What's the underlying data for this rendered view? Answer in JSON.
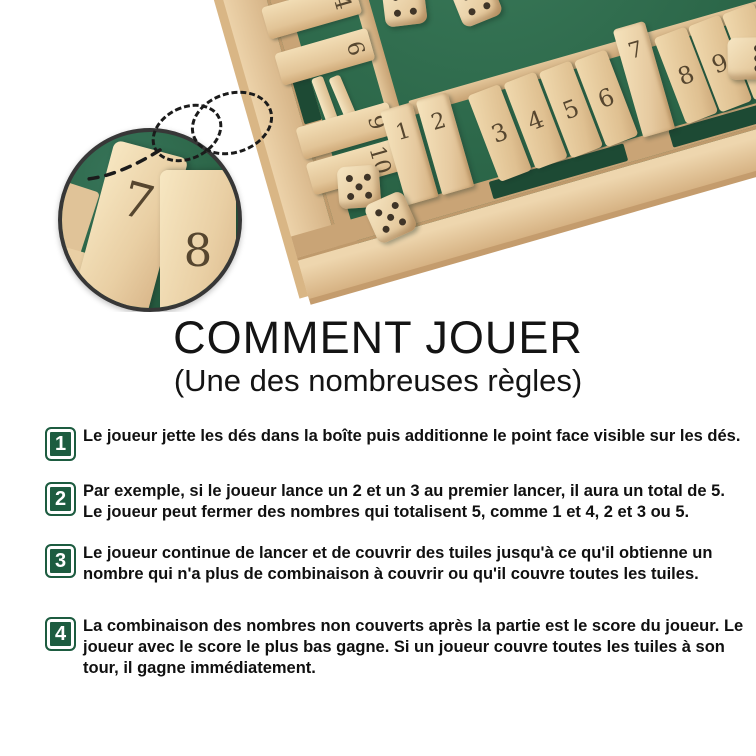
{
  "heading": {
    "title": "COMMENT JOUER",
    "subtitle": "(Une des nombreuses règles)"
  },
  "steps": [
    {
      "number": "1",
      "text": "Le joueur jette les dés dans la boîte puis additionne le point face visible sur les dés."
    },
    {
      "number": "2",
      "text": "Par exemple, si le joueur lance un 2 et un 3 au premier lancer, il aura un total de 5. Le joueur peut fermer des nombres qui totalisent 5, comme 1 et 4, 2 et 3 ou 5."
    },
    {
      "number": "3",
      "text": "Le joueur continue de lancer et de couvrir des tuiles jusqu'à ce qu'il obtienne un nombre qui n'a plus de combinaison à couvrir ou qu'il couvre toutes les tuiles."
    },
    {
      "number": "4",
      "text": "La combinaison des nombres non couverts après la partie est le score du joueur. Le joueur avec le score le plus bas gagne. Si un joueur couvre toutes les tuiles à son tour, il gagne immédiatement."
    }
  ],
  "photo": {
    "board": {
      "felt_color": "#2c6749",
      "wood_color": "#e8cfa6",
      "number_color": "#56462f",
      "left_tiles": [
        "4",
        "6",
        "9",
        "10"
      ],
      "standing_tiles": [
        "1",
        "2"
      ],
      "flat_tiles": [
        "3",
        "4",
        "5",
        "6"
      ],
      "standing_tile_7": "7",
      "right_flat_tiles": [
        "8",
        "9",
        "10"
      ]
    },
    "inset": {
      "tile_numbers": [
        "7",
        "8"
      ]
    },
    "dice": [
      {
        "pips": 4
      },
      {
        "pips": 4
      },
      {
        "pips": 5
      },
      {
        "pips": 5
      },
      {
        "pips": 3
      }
    ]
  },
  "colors": {
    "badge_green": "#1d5c40",
    "text_black": "#101010",
    "background": "#ffffff"
  }
}
